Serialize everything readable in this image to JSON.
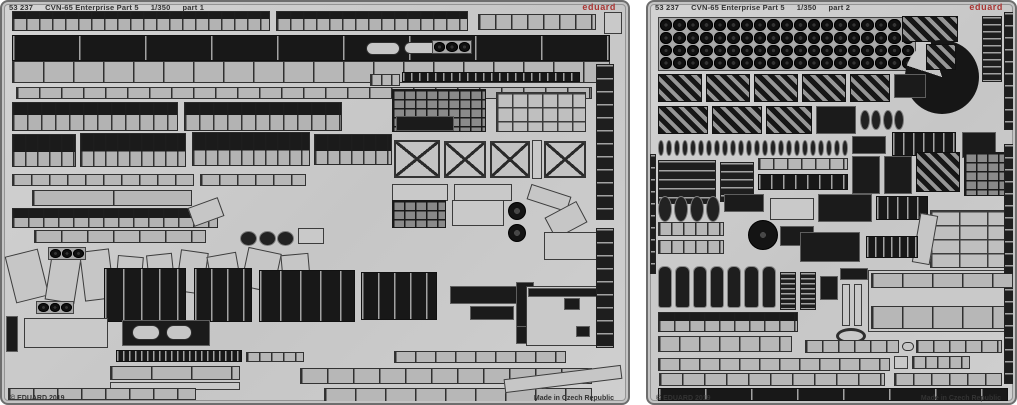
{
  "colors": {
    "paper": "#ffffff",
    "sheet": "#cbcbcb",
    "etch_dark": "#1b1b1b",
    "etch_mid": "#9b9b9b",
    "brand_red": "#a93533",
    "text": "#333333"
  },
  "sheets": [
    {
      "name": "left-fret",
      "frame": {
        "x": 0,
        "y": 0,
        "w": 630,
        "h": 405
      },
      "header": {
        "code": "53 237",
        "title": "CVN-65 Enterprise Part 5",
        "scale": "1/350",
        "part": "part 1"
      },
      "brand": "eduard",
      "copyright": "© EDUARD 2019",
      "made_in": "Made in Czech Republic",
      "parts": [
        [
          "rail",
          8,
          7,
          258,
          20,
          13,
          40
        ],
        [
          "rail",
          272,
          7,
          192,
          20,
          13,
          40
        ],
        [
          "seg",
          474,
          10,
          118,
          16,
          16
        ],
        [
          "light",
          600,
          8,
          18,
          22
        ],
        [
          "darkseg",
          8,
          31,
          598,
          26,
          66
        ],
        [
          "seg",
          8,
          57,
          598,
          22,
          30
        ],
        [
          "seg",
          12,
          83,
          576,
          12,
          22
        ],
        [
          "rail",
          8,
          98,
          166,
          29,
          14,
          45
        ],
        [
          "rail",
          180,
          98,
          158,
          29,
          14,
          45
        ],
        [
          "pill",
          362,
          38,
          34,
          13
        ],
        [
          "pill",
          400,
          38,
          40,
          12
        ],
        [
          "circles",
          428,
          36,
          40,
          14,
          3,
          1
        ],
        [
          "darkseg",
          398,
          68,
          178,
          10,
          8
        ],
        [
          "seg",
          366,
          70,
          30,
          12,
          10
        ],
        [
          "grid",
          388,
          85,
          94,
          43
        ],
        [
          "dark",
          392,
          112,
          58,
          15
        ],
        [
          "gridlight",
          492,
          88,
          90,
          40,
          15
        ],
        [
          "rail",
          8,
          130,
          64,
          33,
          12,
          55
        ],
        [
          "rail",
          76,
          129,
          106,
          34,
          12,
          55
        ],
        [
          "rail",
          188,
          128,
          118,
          34,
          12,
          55
        ],
        [
          "rail",
          310,
          130,
          78,
          31,
          12,
          55
        ],
        [
          "x",
          390,
          136,
          46,
          38
        ],
        [
          "x",
          440,
          137,
          42,
          37
        ],
        [
          "x",
          486,
          137,
          40,
          37
        ],
        [
          "light",
          528,
          136,
          10,
          39
        ],
        [
          "x",
          540,
          137,
          42,
          37
        ],
        [
          "seg",
          8,
          170,
          182,
          12,
          18
        ],
        [
          "seg",
          196,
          170,
          106,
          12,
          18
        ],
        [
          "light",
          388,
          180,
          56,
          17
        ],
        [
          "light",
          450,
          180,
          58,
          17
        ],
        [
          "seg",
          28,
          186,
          160,
          16,
          80
        ],
        [
          "rail",
          8,
          204,
          206,
          20,
          15,
          50
        ],
        [
          "diag",
          186,
          198,
          32,
          20,
          -20
        ],
        [
          "seg",
          30,
          226,
          172,
          13,
          26
        ],
        [
          "ovals",
          236,
          227,
          54,
          15,
          3
        ],
        [
          "light",
          294,
          224,
          26,
          16
        ],
        [
          "diag",
          6,
          248,
          34,
          48,
          -14
        ],
        [
          "diag",
          44,
          252,
          30,
          46,
          9
        ],
        [
          "diag",
          78,
          246,
          30,
          50,
          -7
        ],
        [
          "circles",
          44,
          243,
          38,
          13,
          3,
          1
        ],
        [
          "diag",
          112,
          252,
          26,
          44,
          5
        ],
        [
          "diag",
          144,
          250,
          26,
          40,
          -6
        ],
        [
          "diag",
          174,
          247,
          28,
          42,
          8
        ],
        [
          "diag",
          206,
          250,
          30,
          44,
          -10
        ],
        [
          "diag",
          240,
          246,
          34,
          40,
          12
        ],
        [
          "diag",
          278,
          250,
          28,
          38,
          -5
        ],
        [
          "circles",
          32,
          297,
          38,
          13,
          3,
          1
        ],
        [
          "circles",
          104,
          297,
          38,
          13,
          3,
          1
        ],
        [
          "darkseg",
          100,
          264,
          82,
          54,
          18
        ],
        [
          "darkseg",
          190,
          264,
          58,
          54,
          16
        ],
        [
          "darkseg",
          255,
          266,
          96,
          52,
          20
        ],
        [
          "darkseg",
          357,
          268,
          76,
          48,
          16
        ],
        [
          "grid",
          388,
          196,
          54,
          28
        ],
        [
          "light",
          448,
          196,
          52,
          26
        ],
        [
          "disc",
          504,
          198,
          18,
          18
        ],
        [
          "disc",
          504,
          220,
          18,
          18
        ],
        [
          "diag",
          524,
          186,
          42,
          16,
          18
        ],
        [
          "diag",
          544,
          204,
          36,
          24,
          -28
        ],
        [
          "light",
          540,
          228,
          58,
          28
        ],
        [
          "dark",
          446,
          282,
          72,
          18
        ],
        [
          "dark",
          466,
          302,
          44,
          14
        ],
        [
          "dark",
          512,
          278,
          18,
          62
        ],
        [
          "dark",
          512,
          322,
          74,
          18
        ],
        [
          "light",
          522,
          282,
          80,
          60
        ],
        [
          "dark",
          524,
          284,
          76,
          9
        ],
        [
          "dark",
          560,
          294,
          16,
          12
        ],
        [
          "dark",
          572,
          322,
          14,
          11
        ],
        [
          "dark",
          2,
          312,
          12,
          36
        ],
        [
          "light",
          20,
          314,
          84,
          30
        ],
        [
          "dark",
          118,
          316,
          88,
          26
        ],
        [
          "pill",
          128,
          321,
          28,
          15
        ],
        [
          "pill",
          162,
          321,
          26,
          15
        ],
        [
          "darkseg",
          112,
          346,
          126,
          12,
          6
        ],
        [
          "seg",
          242,
          348,
          58,
          10,
          12
        ],
        [
          "seg",
          106,
          362,
          130,
          14,
          40
        ],
        [
          "light",
          106,
          378,
          130,
          8
        ],
        [
          "seg",
          4,
          384,
          188,
          12,
          24
        ],
        [
          "seg",
          390,
          347,
          172,
          12,
          20
        ],
        [
          "seg",
          296,
          364,
          292,
          16,
          26
        ],
        [
          "seg",
          320,
          384,
          268,
          14,
          30
        ],
        [
          "diag",
          500,
          368,
          118,
          14,
          -7
        ],
        [
          "vseg",
          592,
          60,
          18,
          156,
          13
        ],
        [
          "vseg",
          592,
          224,
          18,
          120,
          13
        ]
      ]
    },
    {
      "name": "right-fret",
      "frame": {
        "x": 646,
        "y": 0,
        "w": 371,
        "h": 405
      },
      "header": {
        "code": "53 237",
        "title": "CVN-65 Enterprise Part 5",
        "scale": "1/350",
        "part": "part 2"
      },
      "brand": "eduard",
      "copyright": "© EDUARD 2019",
      "made_in": "Made in Czech Republic",
      "parts": [
        [
          "circles",
          8,
          13,
          258,
          54,
          19,
          4
        ],
        [
          "hatch",
          252,
          12,
          56,
          26
        ],
        [
          "pacdisc",
          255,
          36,
          74,
          74
        ],
        [
          "hatch",
          276,
          40,
          30,
          26
        ],
        [
          "vseg",
          332,
          12,
          20,
          66,
          7
        ],
        [
          "hatch",
          8,
          70,
          44,
          28
        ],
        [
          "hatch",
          56,
          70,
          44,
          28
        ],
        [
          "hatch",
          104,
          70,
          44,
          28
        ],
        [
          "hatch",
          152,
          70,
          44,
          28
        ],
        [
          "hatch",
          200,
          70,
          40,
          28
        ],
        [
          "dark",
          244,
          70,
          32,
          24
        ],
        [
          "hatch",
          8,
          102,
          50,
          28
        ],
        [
          "hatch",
          62,
          102,
          50,
          28
        ],
        [
          "hatch",
          116,
          102,
          46,
          28
        ],
        [
          "dark",
          166,
          102,
          40,
          28
        ],
        [
          "ovals",
          210,
          106,
          44,
          20,
          4
        ],
        [
          "ovals",
          8,
          136,
          190,
          16,
          24
        ],
        [
          "dark",
          202,
          132,
          34,
          18
        ],
        [
          "darkseg",
          242,
          128,
          64,
          24,
          10
        ],
        [
          "dark",
          312,
          128,
          34,
          26
        ],
        [
          "vseg",
          8,
          156,
          58,
          44,
          9
        ],
        [
          "vseg",
          70,
          158,
          34,
          40,
          8
        ],
        [
          "seg",
          108,
          154,
          90,
          12,
          14
        ],
        [
          "darkseg",
          108,
          170,
          90,
          16,
          12
        ],
        [
          "dark",
          202,
          152,
          28,
          38
        ],
        [
          "dark",
          234,
          152,
          28,
          38
        ],
        [
          "hatch",
          266,
          148,
          44,
          40
        ],
        [
          "grid",
          314,
          148,
          44,
          44
        ],
        [
          "ovals",
          8,
          192,
          62,
          26,
          4
        ],
        [
          "dark",
          74,
          190,
          40,
          18
        ],
        [
          "light",
          120,
          194,
          44,
          22
        ],
        [
          "dark",
          168,
          190,
          54,
          28
        ],
        [
          "darkseg",
          226,
          192,
          52,
          24,
          10
        ],
        [
          "disc",
          98,
          216,
          30,
          30
        ],
        [
          "dark",
          130,
          222,
          34,
          20
        ],
        [
          "gridlight",
          280,
          206,
          86,
          58,
          28
        ],
        [
          "diag",
          266,
          210,
          18,
          50,
          10
        ],
        [
          "seg",
          8,
          218,
          66,
          14,
          12
        ],
        [
          "seg",
          8,
          236,
          66,
          14,
          12
        ],
        [
          "dark",
          150,
          228,
          60,
          30
        ],
        [
          "darkseg",
          216,
          232,
          52,
          22,
          8
        ],
        [
          "bottles",
          8,
          262,
          118,
          42,
          7
        ],
        [
          "vseg",
          130,
          268,
          16,
          38,
          5
        ],
        [
          "vseg",
          150,
          268,
          16,
          38,
          5
        ],
        [
          "dark",
          170,
          272,
          18,
          24
        ],
        [
          "dark",
          190,
          264,
          28,
          12
        ],
        [
          "light",
          192,
          280,
          8,
          42
        ],
        [
          "light",
          204,
          280,
          8,
          42
        ],
        [
          "ring",
          186,
          324,
          30,
          16
        ],
        [
          "light",
          218,
          266,
          148,
          62
        ],
        [
          "seg",
          221,
          269,
          142,
          15,
          30
        ],
        [
          "seg",
          221,
          302,
          142,
          23,
          30
        ],
        [
          "rail",
          8,
          308,
          140,
          20,
          15,
          45
        ],
        [
          "seg",
          8,
          332,
          134,
          16,
          20
        ],
        [
          "seg",
          155,
          336,
          94,
          13,
          16
        ],
        [
          "pill",
          252,
          338,
          12,
          9
        ],
        [
          "seg",
          266,
          336,
          86,
          13,
          16
        ],
        [
          "seg",
          8,
          354,
          232,
          13,
          20
        ],
        [
          "light",
          244,
          352,
          14,
          13
        ],
        [
          "seg",
          262,
          352,
          58,
          13,
          12
        ],
        [
          "seg",
          9,
          369,
          226,
          13,
          22
        ],
        [
          "seg",
          244,
          369,
          108,
          13,
          18
        ],
        [
          "darkseg",
          8,
          384,
          350,
          13,
          46
        ],
        [
          "vseg",
          354,
          8,
          13,
          118,
          12
        ],
        [
          "vseg",
          354,
          140,
          13,
          130,
          12
        ],
        [
          "vseg",
          354,
          284,
          13,
          96,
          12
        ],
        [
          "vseg",
          0,
          150,
          6,
          120,
          12
        ]
      ]
    }
  ]
}
